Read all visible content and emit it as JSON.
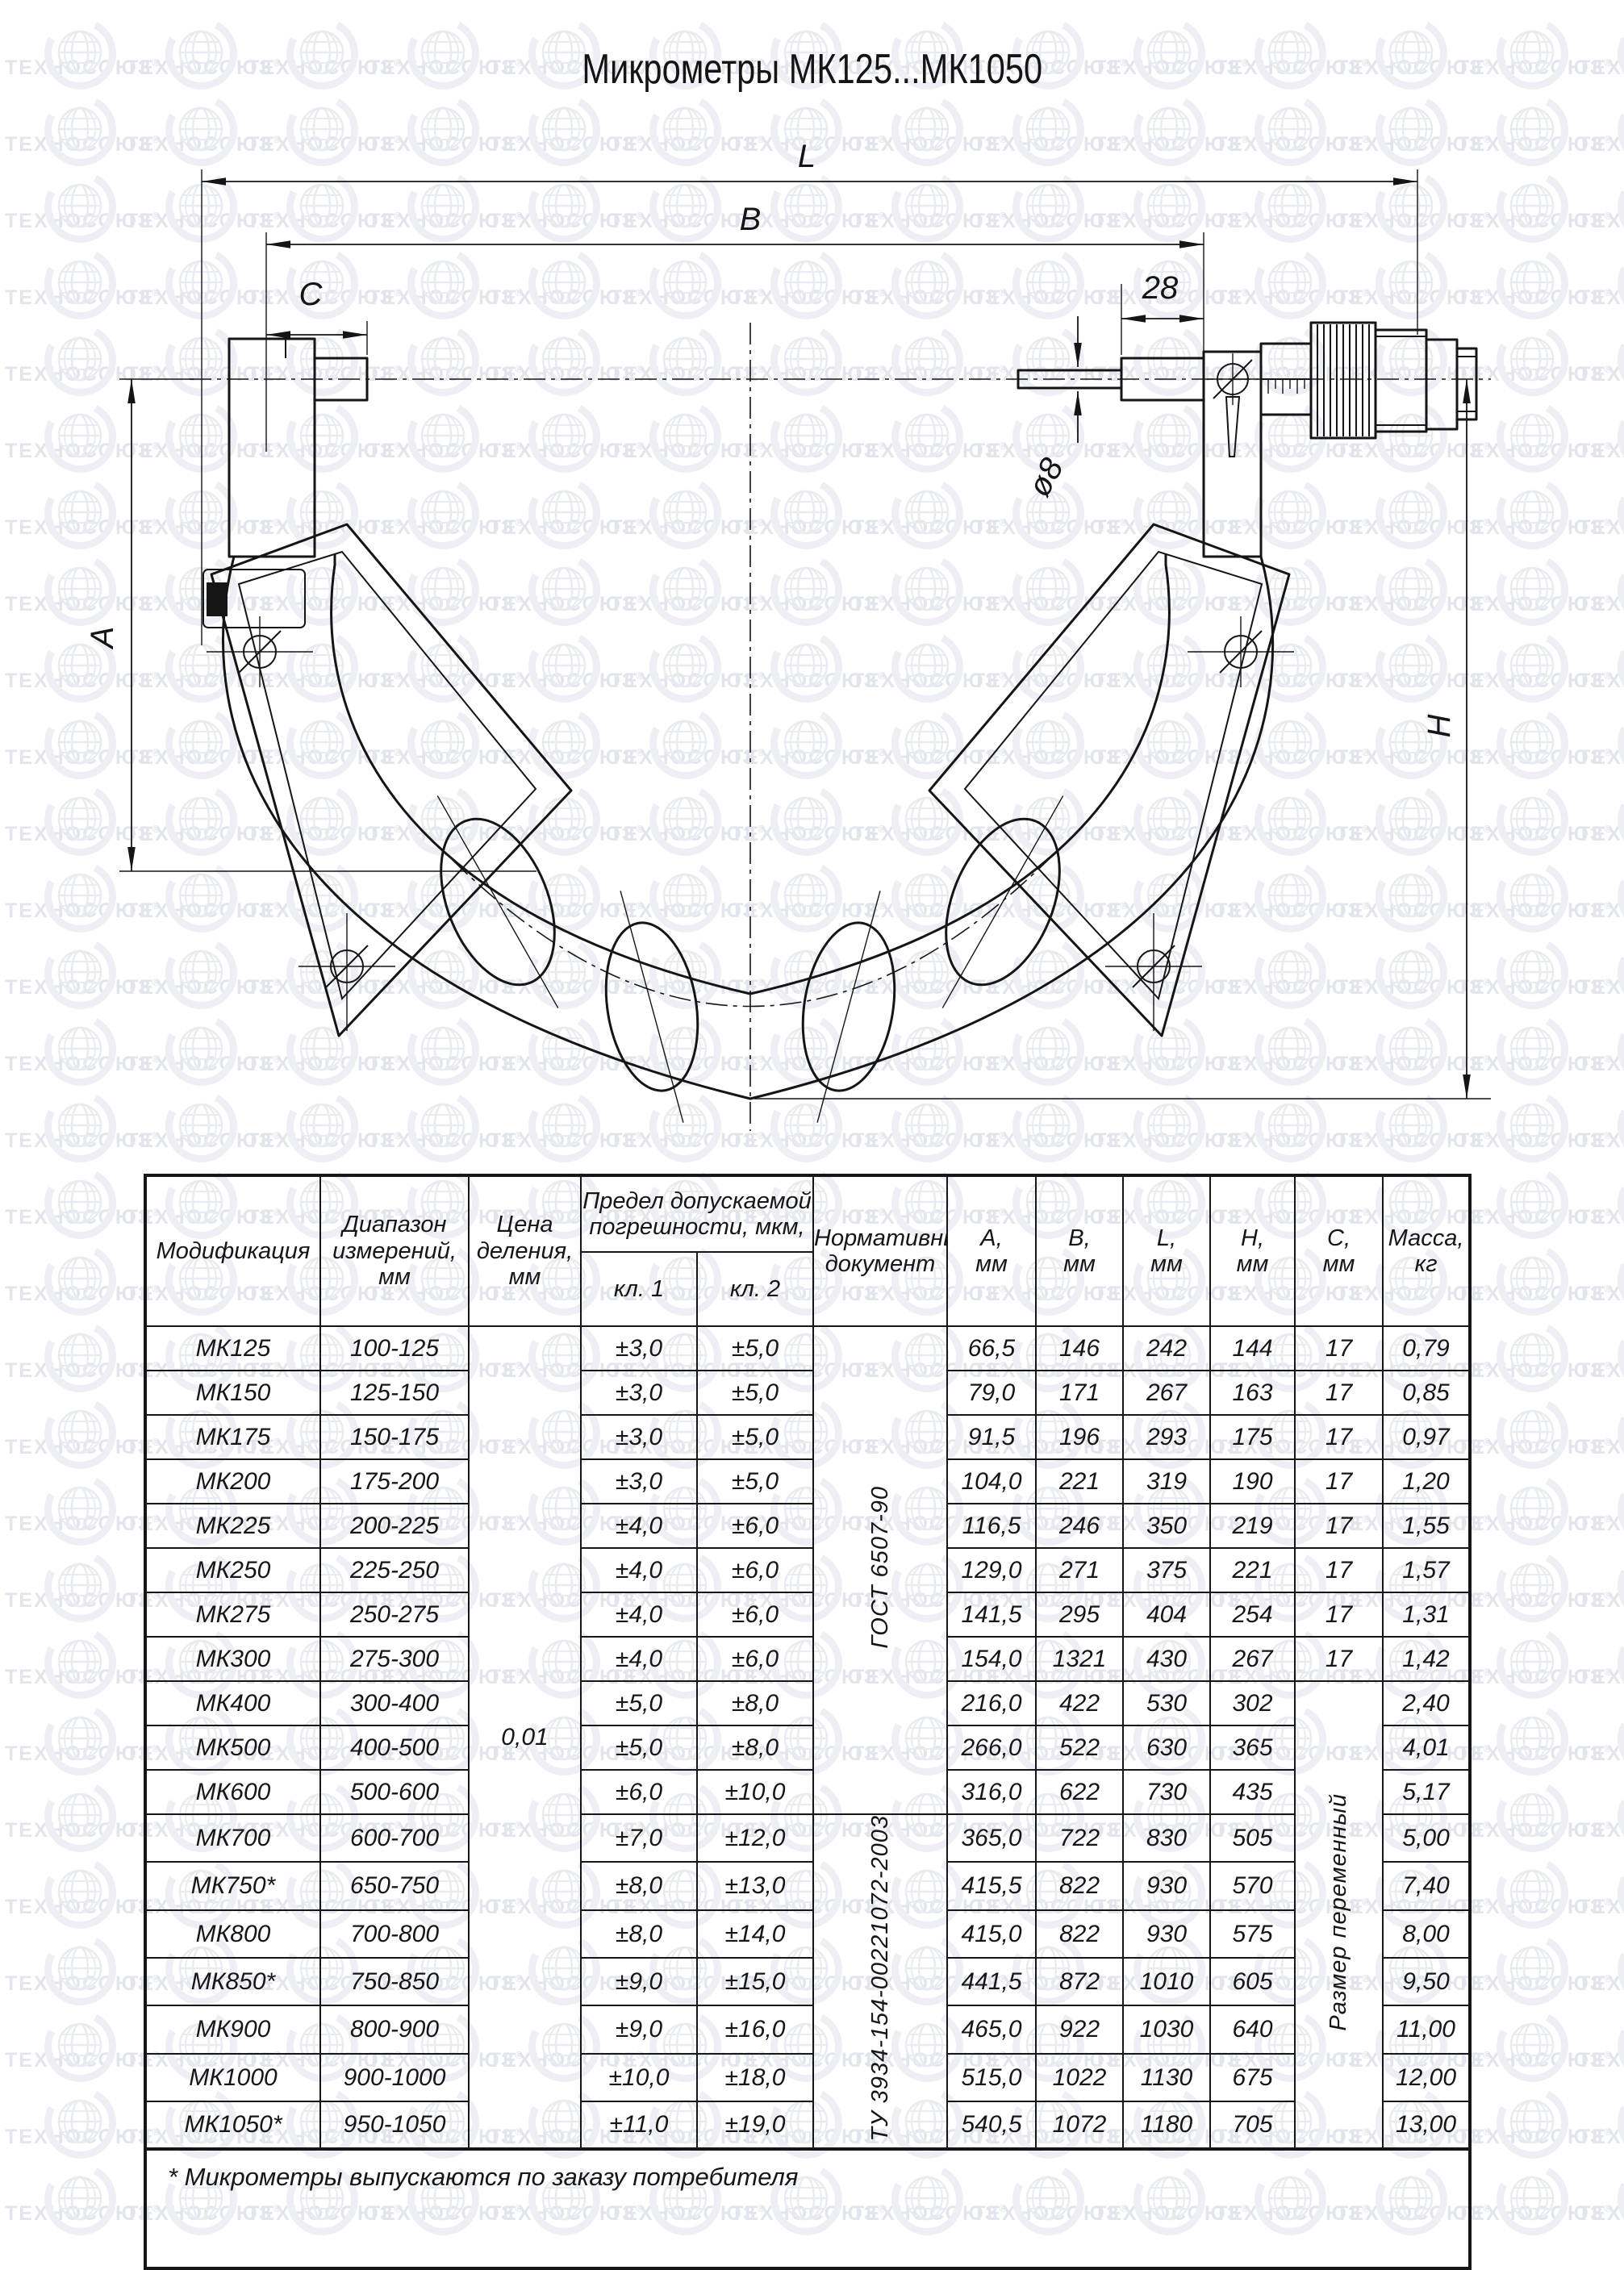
{
  "watermark": {
    "text": "ТЕХНОСОЮЗ",
    "reg": "®"
  },
  "title": "Микрометры МК125...МК1050",
  "drawing": {
    "labels": {
      "L": "L",
      "B": "B",
      "C": "C",
      "n28": "28",
      "d8": "ø8",
      "A": "А",
      "H": "Н"
    }
  },
  "table": {
    "headers": {
      "mod": "Модификация",
      "range": "Диапазон\nизмерений,\nмм",
      "division": "Цена\nделения,\nмм",
      "limit": "Предел допускаемой\nпогрешности, мкм,",
      "cl1": "кл. 1",
      "cl2": "кл. 2",
      "normdoc": "Нормативный\nдокумент",
      "a": "А,\nмм",
      "b": "В,\nмм",
      "l": "L,\nмм",
      "h": "Н,\nмм",
      "c": "С,\nмм",
      "mass": "Масса,\nкг"
    },
    "merged": {
      "division_value": "0,01",
      "gost": "ГОСТ 6507-90",
      "tu": "ТУ 3934-154-00221072-2003",
      "c_variable": "Размер переменный"
    },
    "rows": [
      {
        "m": "МК125",
        "r": "100-125",
        "c1": "±3,0",
        "c2": "±5,0",
        "a": "66,5",
        "b": "146",
        "l": "242",
        "h": "144",
        "c": "17",
        "kg": "0,79"
      },
      {
        "m": "МК150",
        "r": "125-150",
        "c1": "±3,0",
        "c2": "±5,0",
        "a": "79,0",
        "b": "171",
        "l": "267",
        "h": "163",
        "c": "17",
        "kg": "0,85"
      },
      {
        "m": "МК175",
        "r": "150-175",
        "c1": "±3,0",
        "c2": "±5,0",
        "a": "91,5",
        "b": "196",
        "l": "293",
        "h": "175",
        "c": "17",
        "kg": "0,97"
      },
      {
        "m": "МК200",
        "r": "175-200",
        "c1": "±3,0",
        "c2": "±5,0",
        "a": "104,0",
        "b": "221",
        "l": "319",
        "h": "190",
        "c": "17",
        "kg": "1,20"
      },
      {
        "m": "МК225",
        "r": "200-225",
        "c1": "±4,0",
        "c2": "±6,0",
        "a": "116,5",
        "b": "246",
        "l": "350",
        "h": "219",
        "c": "17",
        "kg": "1,55"
      },
      {
        "m": "МК250",
        "r": "225-250",
        "c1": "±4,0",
        "c2": "±6,0",
        "a": "129,0",
        "b": "271",
        "l": "375",
        "h": "221",
        "c": "17",
        "kg": "1,57"
      },
      {
        "m": "МК275",
        "r": "250-275",
        "c1": "±4,0",
        "c2": "±6,0",
        "a": "141,5",
        "b": "295",
        "l": "404",
        "h": "254",
        "c": "17",
        "kg": "1,31"
      },
      {
        "m": "МК300",
        "r": "275-300",
        "c1": "±4,0",
        "c2": "±6,0",
        "a": "154,0",
        "b": "1321",
        "l": "430",
        "h": "267",
        "c": "17",
        "kg": "1,42"
      },
      {
        "m": "МК400",
        "r": "300-400",
        "c1": "±5,0",
        "c2": "±8,0",
        "a": "216,0",
        "b": "422",
        "l": "530",
        "h": "302",
        "kg": "2,40"
      },
      {
        "m": "МК500",
        "r": "400-500",
        "c1": "±5,0",
        "c2": "±8,0",
        "a": "266,0",
        "b": "522",
        "l": "630",
        "h": "365",
        "kg": "4,01"
      },
      {
        "m": "МК600",
        "r": "500-600",
        "c1": "±6,0",
        "c2": "±10,0",
        "a": "316,0",
        "b": "622",
        "l": "730",
        "h": "435",
        "kg": "5,17"
      },
      {
        "m": "МК700",
        "r": "600-700",
        "c1": "±7,0",
        "c2": "±12,0",
        "a": "365,0",
        "b": "722",
        "l": "830",
        "h": "505",
        "kg": "5,00"
      },
      {
        "m": "МК750*",
        "r": "650-750",
        "c1": "±8,0",
        "c2": "±13,0",
        "a": "415,5",
        "b": "822",
        "l": "930",
        "h": "570",
        "kg": "7,40"
      },
      {
        "m": "МК800",
        "r": "700-800",
        "c1": "±8,0",
        "c2": "±14,0",
        "a": "415,0",
        "b": "822",
        "l": "930",
        "h": "575",
        "kg": "8,00"
      },
      {
        "m": "МК850*",
        "r": "750-850",
        "c1": "±9,0",
        "c2": "±15,0",
        "a": "441,5",
        "b": "872",
        "l": "1010",
        "h": "605",
        "kg": "9,50"
      },
      {
        "m": "МК900",
        "r": "800-900",
        "c1": "±9,0",
        "c2": "±16,0",
        "a": "465,0",
        "b": "922",
        "l": "1030",
        "h": "640",
        "kg": "11,00"
      },
      {
        "m": "МК1000",
        "r": "900-1000",
        "c1": "±10,0",
        "c2": "±18,0",
        "a": "515,0",
        "b": "1022",
        "l": "1130",
        "h": "675",
        "kg": "12,00"
      },
      {
        "m": "МК1050*",
        "r": "950-1050",
        "c1": "±11,0",
        "c2": "±19,0",
        "a": "540,5",
        "b": "1072",
        "l": "1180",
        "h": "705",
        "kg": "13,00"
      }
    ],
    "footnote": "* Микрометры выпускаются по заказу потребителя"
  }
}
